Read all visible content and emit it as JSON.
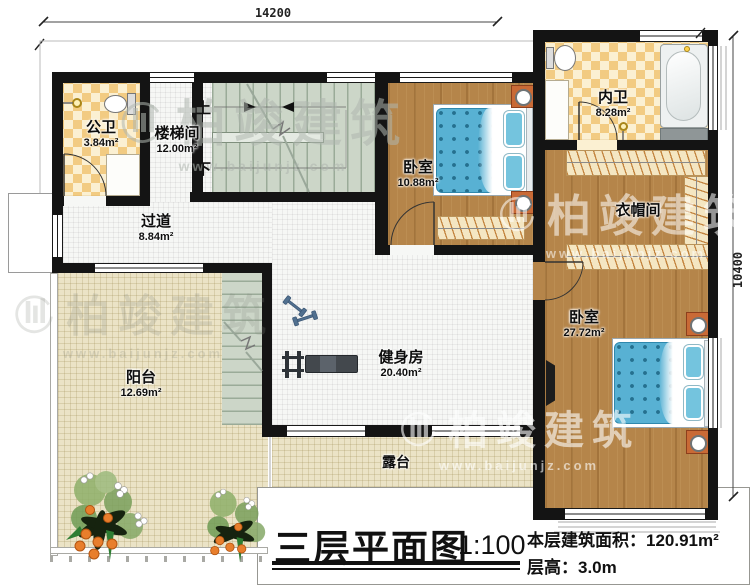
{
  "title_block": {
    "plan_title": "三层平面图",
    "scale": "1:100",
    "area_label": "本层建筑面积：",
    "area_value": "120.91m²",
    "height_label": "层高：",
    "height_value": "3.0m"
  },
  "dimensions": {
    "width_mm": "14200",
    "height_mm": "10400"
  },
  "rooms": {
    "public_bath": {
      "name": "公卫",
      "area": "3.84m²"
    },
    "stairwell": {
      "name": "楼梯间",
      "area": "12.00m²"
    },
    "hallway": {
      "name": "过道",
      "area": "8.84m²"
    },
    "bedroom_small": {
      "name": "卧室",
      "area": "10.88m²"
    },
    "master_bath": {
      "name": "内卫",
      "area": "8.28m²"
    },
    "closet": {
      "name": "衣帽间"
    },
    "bedroom_master": {
      "name": "卧室",
      "area": "27.72m²"
    },
    "gym": {
      "name": "健身房",
      "area": "20.40m²"
    },
    "balcony": {
      "name": "阳台",
      "area": "12.69m²"
    },
    "terrace": {
      "name": "露台"
    }
  },
  "stairs": {
    "up_label": "上",
    "down_label": "下"
  },
  "watermark": {
    "brand": "柏竣建筑",
    "url": "www.baijunjz.com"
  },
  "colors": {
    "wall": "#141414",
    "wood_floor": "#b5854a",
    "checker_tile_a": "#f2cb82",
    "checker_tile_b": "#fbf0d2",
    "stair": "#ccd6c8",
    "white_tile": "#f6f7f5",
    "beige_tile": "#ebe3c6",
    "bed_blue": "#58b1d3",
    "nightstand_orange": "#c96a36",
    "wardrobe_cream": "#f4e6c2"
  }
}
